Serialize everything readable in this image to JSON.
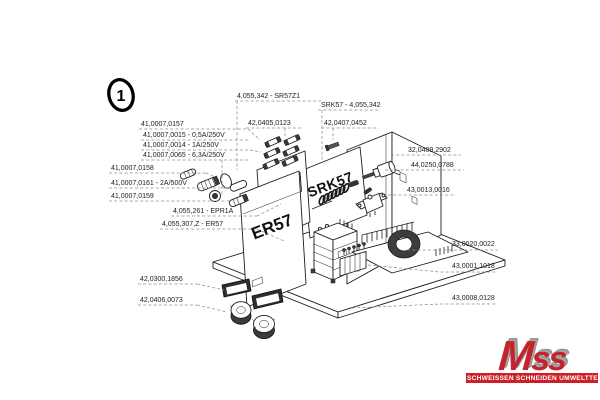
{
  "figure": {
    "callout_number": "1"
  },
  "panels": {
    "srk57": "SRK57",
    "er57": "ER57",
    "epr1a": "EPR1A"
  },
  "part_labels": [
    {
      "text": "4,055,342 - SR57Z1",
      "x": 237,
      "y": 98,
      "lines": [
        [
          [
            235,
            101
          ],
          [
            322,
            101
          ]
        ],
        [
          [
            237,
            101
          ],
          [
            237,
            170
          ]
        ]
      ]
    },
    {
      "text": "SRK57 - 4,055,342",
      "x": 321,
      "y": 107,
      "lines": [
        [
          [
            318,
            110
          ],
          [
            380,
            110
          ]
        ],
        [
          [
            322,
            110
          ],
          [
            322,
            161
          ]
        ]
      ]
    },
    {
      "text": "42,0405,0123",
      "x": 248,
      "y": 125,
      "lines": [
        [
          [
            246,
            128
          ],
          [
            303,
            128
          ]
        ],
        [
          [
            285,
            128
          ],
          [
            285,
            137
          ]
        ]
      ]
    },
    {
      "text": "42,0407,0452",
      "x": 324,
      "y": 125,
      "lines": [
        [
          [
            321,
            128
          ],
          [
            379,
            128
          ]
        ],
        [
          [
            333,
            128
          ],
          [
            333,
            140
          ]
        ]
      ]
    },
    {
      "text": "41,0007,0157",
      "x": 141,
      "y": 126,
      "lines": [
        [
          [
            139,
            129
          ],
          [
            248,
            129
          ]
        ],
        [
          [
            248,
            129
          ],
          [
            260,
            140
          ]
        ]
      ]
    },
    {
      "text": "41,0007,0015 - 0,5A/250V",
      "x": 143,
      "y": 137,
      "lines": [
        [
          [
            141,
            140
          ],
          [
            250,
            140
          ]
        ]
      ]
    },
    {
      "text": "41,0007,0014 - 1A/250V",
      "x": 143,
      "y": 147,
      "lines": [
        [
          [
            141,
            150
          ],
          [
            250,
            150
          ]
        ],
        [
          [
            250,
            150
          ],
          [
            261,
            152
          ]
        ]
      ]
    },
    {
      "text": "41,0007,0065 - 6,3A/250V",
      "x": 143,
      "y": 157,
      "lines": [
        [
          [
            141,
            160
          ],
          [
            250,
            160
          ]
        ],
        [
          [
            222,
            160
          ],
          [
            222,
            196
          ]
        ]
      ]
    },
    {
      "text": "41,0007,0158",
      "x": 111,
      "y": 170,
      "lines": [
        [
          [
            109,
            173
          ],
          [
            206,
            173
          ]
        ],
        [
          [
            206,
            173
          ],
          [
            215,
            177
          ]
        ]
      ]
    },
    {
      "text": "41,0007,0161 - 2A/500V",
      "x": 111,
      "y": 185,
      "lines": [
        [
          [
            109,
            188
          ],
          [
            231,
            188
          ]
        ]
      ]
    },
    {
      "text": "41,0007,0159",
      "x": 111,
      "y": 198,
      "lines": [
        [
          [
            109,
            201
          ],
          [
            211,
            201
          ]
        ],
        [
          [
            211,
            201
          ],
          [
            230,
            201
          ]
        ]
      ]
    },
    {
      "text": "4,055,261 - EPR1A",
      "x": 173,
      "y": 213,
      "lines": [
        [
          [
            171,
            216
          ],
          [
            257,
            216
          ]
        ],
        [
          [
            257,
            216
          ],
          [
            281,
            204
          ]
        ]
      ]
    },
    {
      "text": "4,055,307,Z - ER57",
      "x": 162,
      "y": 226,
      "color": "#9c9c9c",
      "lines": [
        [
          [
            160,
            229
          ],
          [
            257,
            229
          ]
        ],
        [
          [
            257,
            229
          ],
          [
            284,
            241
          ]
        ]
      ]
    },
    {
      "text": "32,0409,2902",
      "x": 408,
      "y": 152,
      "lines": [
        [
          [
            391,
            155
          ],
          [
            461,
            155
          ]
        ]
      ]
    },
    {
      "text": "44,0250,0788",
      "x": 411,
      "y": 167,
      "lines": [
        [
          [
            385,
            170
          ],
          [
            464,
            170
          ]
        ]
      ]
    },
    {
      "text": "43,0013,0016",
      "x": 407,
      "y": 192,
      "lines": [
        [
          [
            388,
            195
          ],
          [
            456,
            195
          ]
        ]
      ]
    },
    {
      "text": "33,0020,0022",
      "x": 452,
      "y": 246,
      "lines": [
        [
          [
            407,
            250
          ],
          [
            498,
            250
          ]
        ]
      ]
    },
    {
      "text": "43,0001,1018",
      "x": 452,
      "y": 268,
      "lines": [
        [
          [
            368,
            265
          ],
          [
            440,
            272
          ],
          [
            498,
            272
          ]
        ]
      ]
    },
    {
      "text": "43,0008,0128",
      "x": 452,
      "y": 300,
      "lines": [
        [
          [
            352,
            308
          ],
          [
            440,
            304
          ],
          [
            498,
            304
          ]
        ]
      ]
    },
    {
      "text": "42,0300,1856",
      "x": 140,
      "y": 281,
      "lines": [
        [
          [
            138,
            284
          ],
          [
            197,
            284
          ]
        ],
        [
          [
            197,
            284
          ],
          [
            224,
            290
          ]
        ]
      ]
    },
    {
      "text": "42,0406,0073",
      "x": 140,
      "y": 302,
      "lines": [
        [
          [
            138,
            305
          ],
          [
            197,
            305
          ]
        ],
        [
          [
            197,
            305
          ],
          [
            227,
            312
          ]
        ]
      ]
    }
  ],
  "logo": {
    "brand": "Mss",
    "banner": "SCHWEISSEN SCHNEIDEN UMWELTTECHNIK",
    "red": "#c4232b",
    "banner_red": "#cc2026",
    "gray": "#9a9a9a"
  }
}
